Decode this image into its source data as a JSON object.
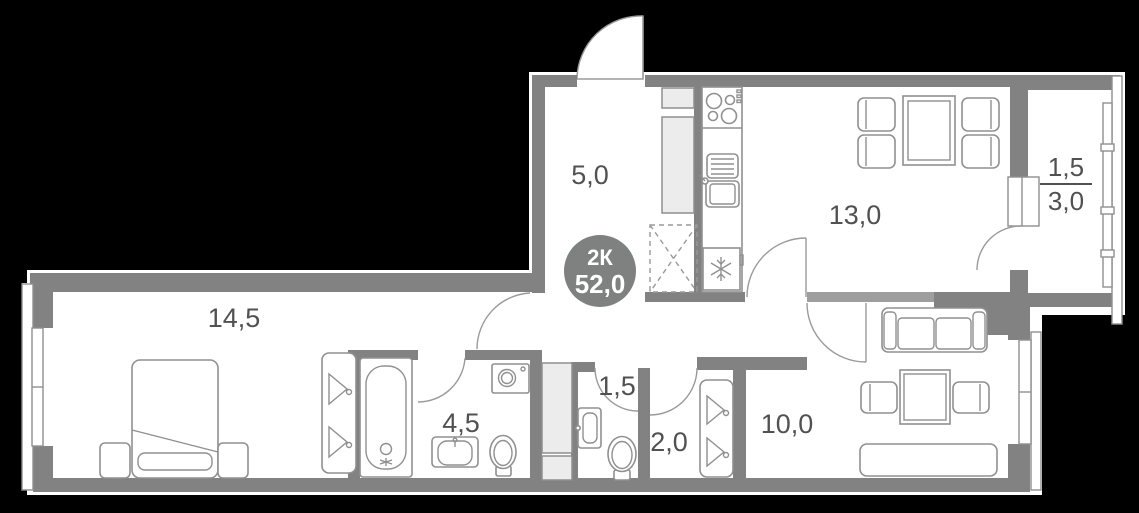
{
  "plan": {
    "badge": {
      "rooms_label": "2К",
      "area_label": "52,0"
    },
    "rooms": [
      {
        "id": "hallway",
        "area": "5,0"
      },
      {
        "id": "kitchen-living",
        "area": "13,0"
      },
      {
        "id": "balcony",
        "area_upper": "1,5",
        "area_lower": "3,0"
      },
      {
        "id": "bedroom",
        "area": "14,5"
      },
      {
        "id": "bathroom",
        "area": "4,5"
      },
      {
        "id": "wc",
        "area": "1,5"
      },
      {
        "id": "closet",
        "area": "2,0"
      },
      {
        "id": "second-room",
        "area": "10,0"
      }
    ],
    "icons": {
      "fridge": "snowflake-icon",
      "stove": "burners-icon",
      "wardrobe": "hanger-icon",
      "planned_wardrobe": "dashed-cross-icon"
    },
    "colors": {
      "background": "#000000",
      "wall": "#828282",
      "wall_light": "#9e9e9e",
      "floor": "#ffffff",
      "badge": "#7f8080",
      "label_text": "#515151",
      "furniture_stroke": "#909090"
    }
  }
}
